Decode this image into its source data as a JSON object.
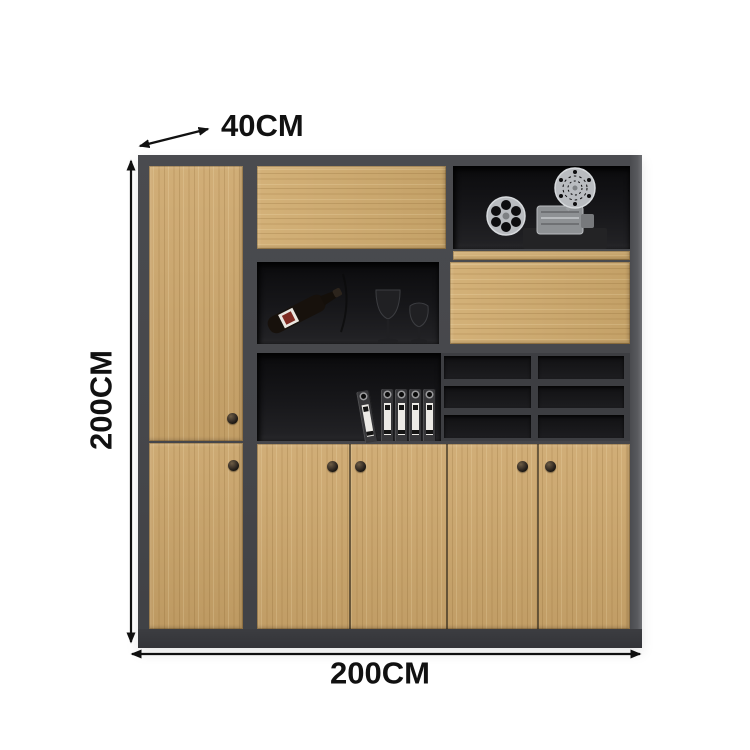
{
  "annotations": {
    "depth_label": "40CM",
    "height_label": "200CM",
    "width_label": "200CM"
  },
  "colors": {
    "background": "#ffffff",
    "annotation_text": "#111111",
    "wood": "#cda76c",
    "frame": "#46474b",
    "interior": "#151517",
    "binder_strip": "#eceae6"
  },
  "cabinet": {
    "description": "two-tone wood and dark grey office filing cabinet",
    "left_column_doors": 2,
    "bottom_doors": 4,
    "knobs": 6,
    "pigeonhole_cells": 6,
    "decor_items": [
      "film projector with reels",
      "wine bottle",
      "wine glasses",
      "file binders"
    ]
  }
}
